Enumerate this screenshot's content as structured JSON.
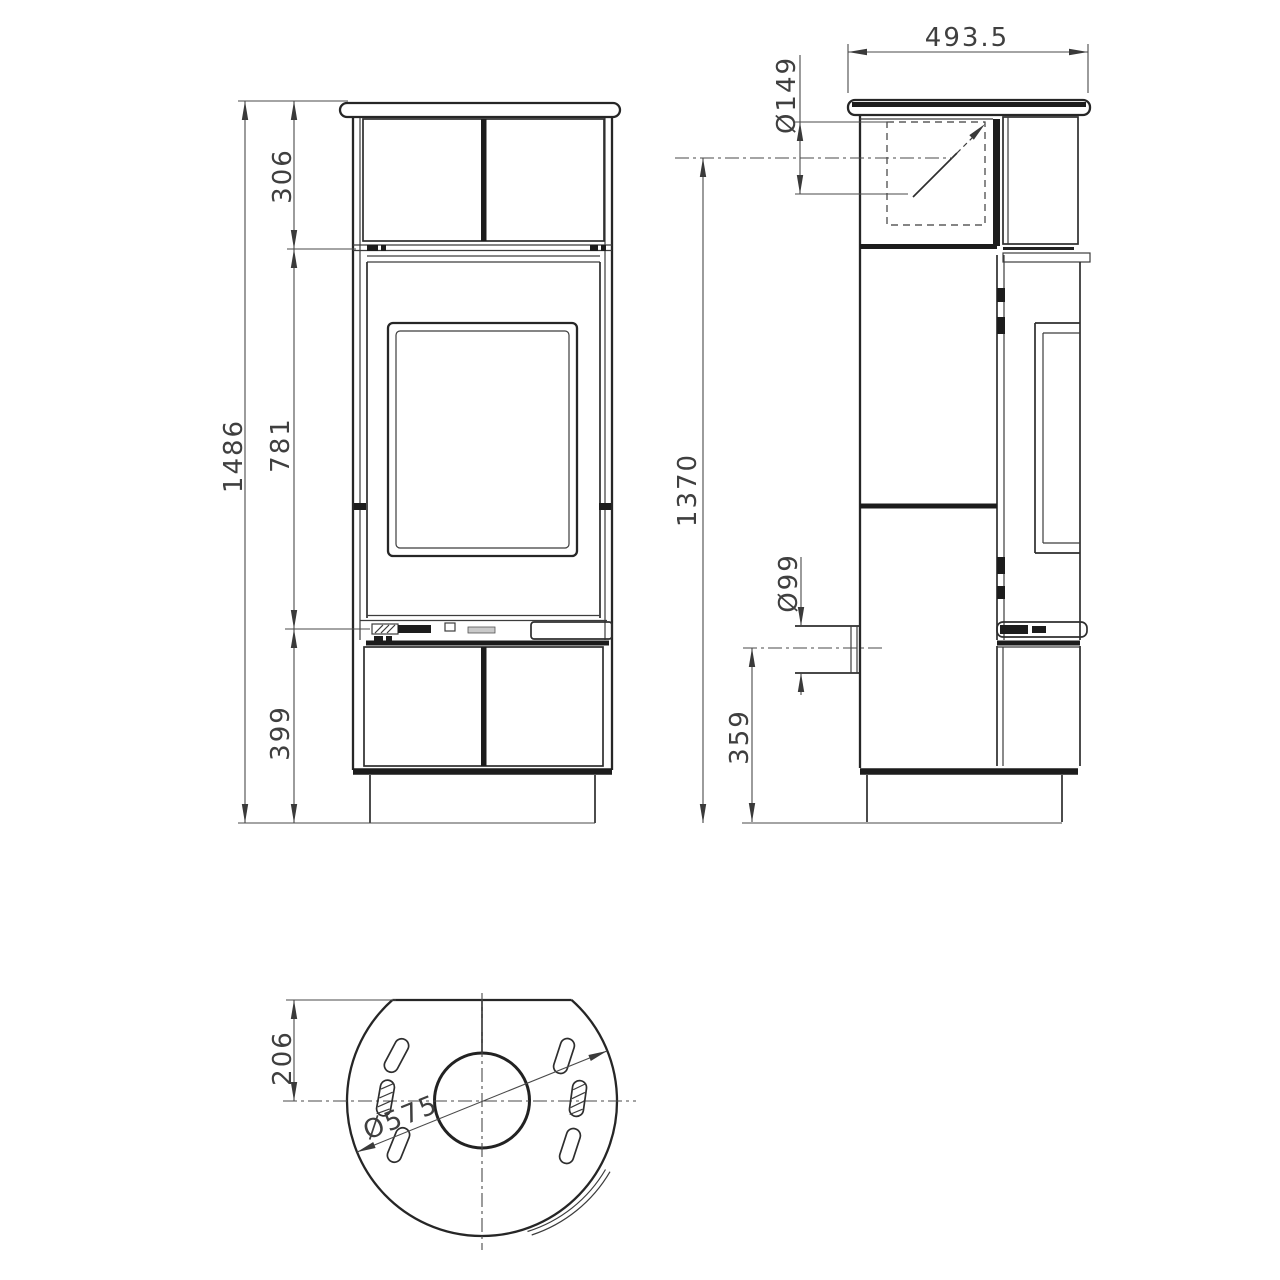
{
  "drawing_type": "stove dimensional drawing, three orthographic views",
  "colors": {
    "background": "#ffffff",
    "line": "#2e2e2e",
    "thick_line": "#1c1c1c",
    "dim_text": "#3f3f3f"
  },
  "views": {
    "front": {
      "label": "front-view",
      "dims": {
        "overall_height": "1486",
        "upper_section": "306",
        "door_section": "781",
        "lower_section": "399"
      }
    },
    "side": {
      "label": "side-view",
      "dims": {
        "top_depth": "493.5",
        "flue_diameter": "Ø149",
        "flue_center_height": "1370",
        "rear_inlet_diameter": "Ø99",
        "rear_inlet_center_height": "359"
      }
    },
    "bottom": {
      "label": "bottom-view",
      "dims": {
        "back_edge_to_center": "206",
        "body_diameter": "Ø575"
      }
    }
  }
}
